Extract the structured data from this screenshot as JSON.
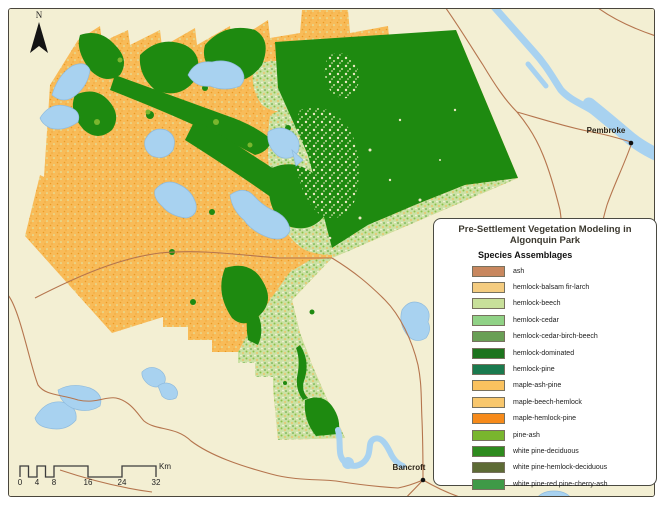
{
  "legend": {
    "title": "Pre-Settlement Vegetation Modeling in Algonquin Park",
    "subtitle": "Species Assemblages",
    "items": [
      {
        "label": "ash",
        "color": "#C8875E"
      },
      {
        "label": "hemlock-balsam fir-larch",
        "color": "#F4CC80"
      },
      {
        "label": "hemlock-beech",
        "color": "#C8E09A"
      },
      {
        "label": "hemlock-cedar",
        "color": "#90D286"
      },
      {
        "label": "hemlock-cedar-birch-beech",
        "color": "#699F55"
      },
      {
        "label": "hemlock-dominated",
        "color": "#1D741D"
      },
      {
        "label": "hemlock-pine",
        "color": "#1A7A4E"
      },
      {
        "label": "maple-ash-pine",
        "color": "#FAC25F"
      },
      {
        "label": "maple-beech-hemlock",
        "color": "#F8C76D"
      },
      {
        "label": "maple-hemlock-pine",
        "color": "#F68A1A"
      },
      {
        "label": "pine-ash",
        "color": "#79B62E"
      },
      {
        "label": "white pine-deciduous",
        "color": "#2E8B1E"
      },
      {
        "label": "white pine-hemlock-deciduous",
        "color": "#5D6B35"
      },
      {
        "label": "white pine-red pine-cherry-ash",
        "color": "#3F9A47"
      }
    ]
  },
  "map": {
    "north_label": "N",
    "cities": [
      {
        "name": "Pembroke"
      },
      {
        "name": "Bancroft"
      }
    ],
    "scale_bar": {
      "ticks": [
        "0",
        "4",
        "8",
        "16",
        "24",
        "32"
      ],
      "unit": "Km"
    },
    "colors": {
      "background": "#F3EFD3",
      "water": "#A8D2F0",
      "park_orange": "#F8BB58",
      "park_dark_green": "#1E8A10",
      "park_light_green": "#CBE1A4",
      "road": "#B5754E"
    }
  }
}
